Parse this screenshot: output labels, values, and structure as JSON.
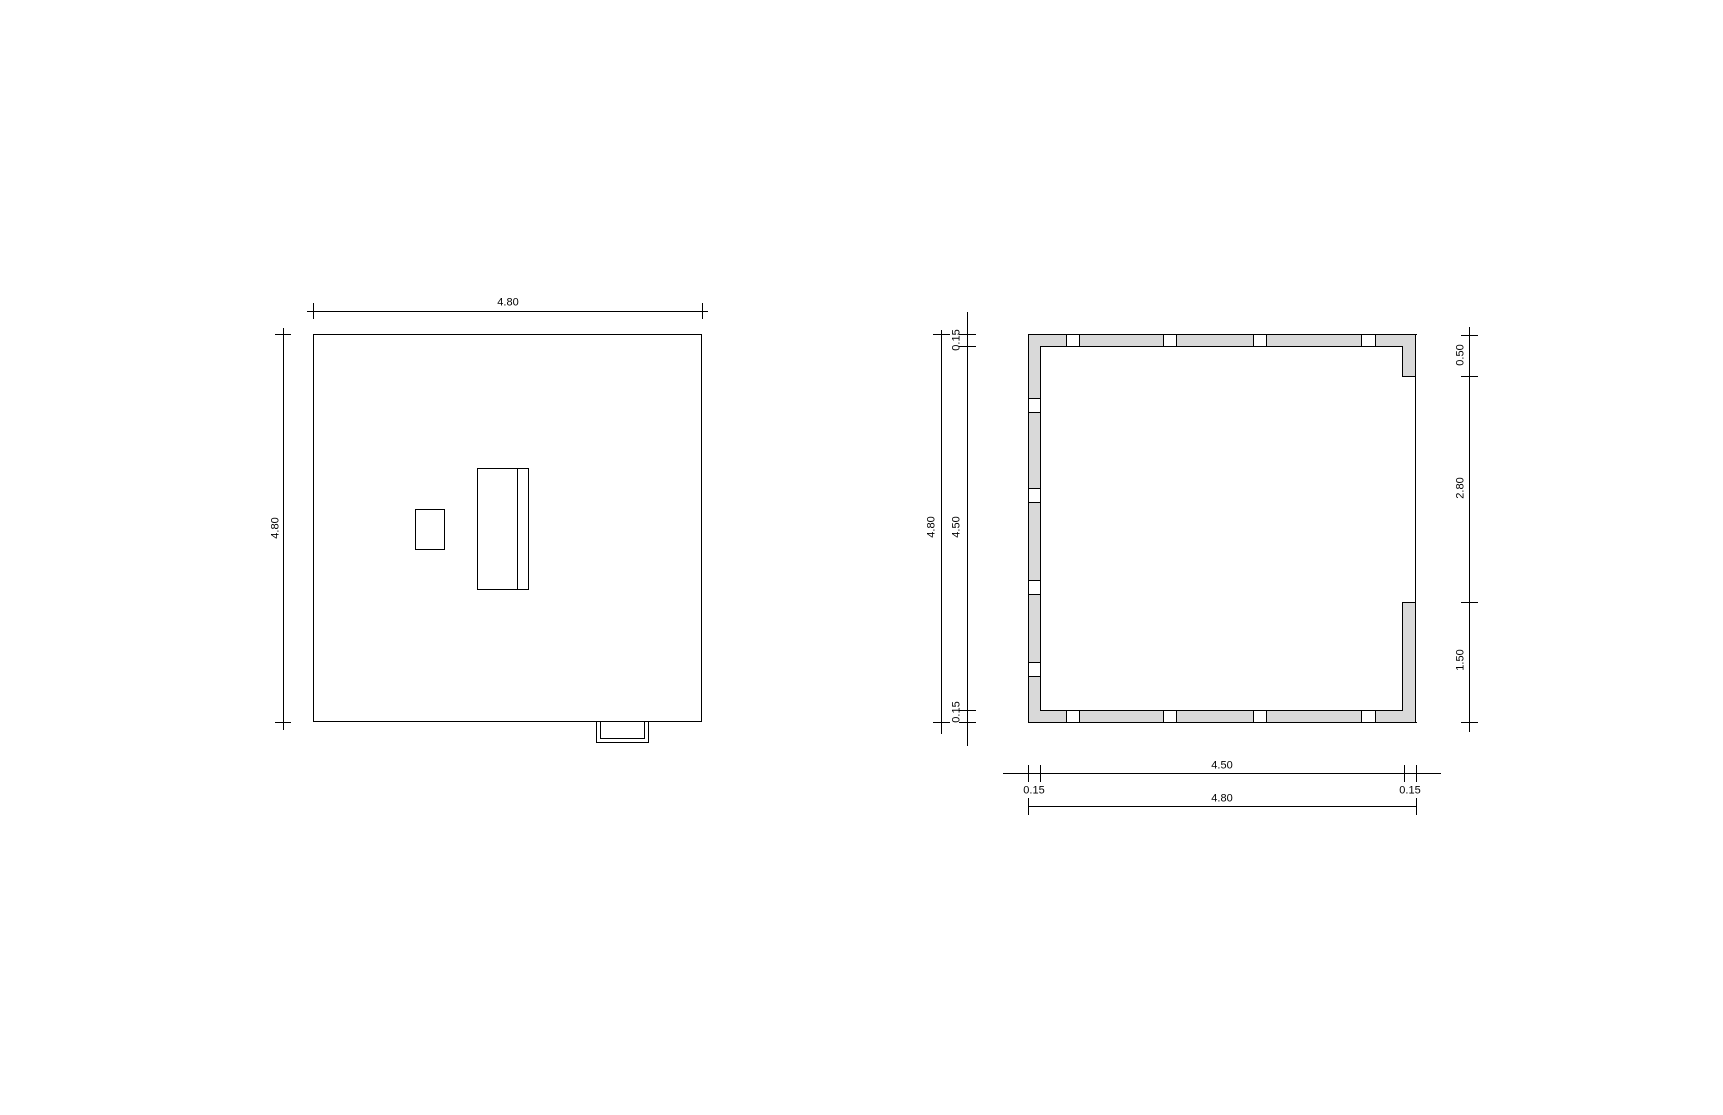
{
  "drawing": {
    "background": "#ffffff",
    "line_color": "#000000",
    "wall_fill": "#d9d9d9"
  },
  "roof_plan": {
    "dim_top": "4.80",
    "dim_left": "4.80"
  },
  "floor_plan": {
    "dim_left_total": "4.80",
    "dim_left_offset_top": "0.15",
    "dim_left_inner": "4.50",
    "dim_left_offset_bottom": "0.15",
    "dim_right_top": "0.50",
    "dim_right_middle": "2.80",
    "dim_right_bottom": "1.50",
    "dim_bottom_offset_left": "0.15",
    "dim_bottom_inner": "4.50",
    "dim_bottom_offset_right": "0.15",
    "dim_bottom_total": "4.80"
  }
}
